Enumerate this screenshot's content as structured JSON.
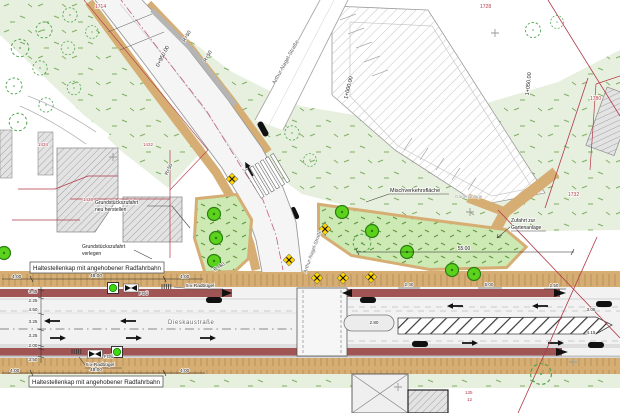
{
  "plan_labels": {
    "stop_cap_top": "Haltestellenkap mit angehobener Radfahrbahn",
    "stop_cap_bottom": "Haltestellenkap mit angehobener Radfahrbahn",
    "mixed_traffic_area": "Mischverkehrsfläche",
    "garden_area_faint": "Gartenanlage",
    "garden_access_l1": "Zufahrt zur",
    "garden_access_l2": "Gartenanlage",
    "driveway_new_l1": "Grundstückszufahrt",
    "driveway_new_l2": "neu herstellen",
    "driveway_relocate_l1": "Grundstückszufahrt",
    "driveway_relocate_l2": "verlegen",
    "bike_racks_top": "5 x Radbügel",
    "bike_racks_bottom": "5 x Radbügel",
    "crosswalk_top": "FGÜ",
    "crosswalk_bottom": "FGÜ"
  },
  "streets": {
    "main": "Dieskaustraße",
    "side_north": "Arthur-Nagel-Straße",
    "side_south": "Arthur-Nagel-Straße"
  },
  "stations": {
    "s0950": "0+950.00",
    "s1000": "1+000.00",
    "s1050": "1+050.00"
  },
  "radii": {
    "r50_a": "R=50",
    "r50_b": "R=50",
    "r50_c": "R=50",
    "r60": "R=60"
  },
  "dimensions": {
    "top_chain": [
      "4.00",
      "48.00",
      "4.00"
    ],
    "bottom_chain": [
      "4.00",
      "48.00",
      "4.00"
    ],
    "cross_section_left": [
      "3.45",
      "2.25",
      "4.50",
      "3.25",
      "3.25",
      "2.00",
      "3.50"
    ],
    "misc": {
      "d55": "55.00",
      "d5": "5.00",
      "d250": "2.50",
      "d240": "2.40",
      "d280": "2.80",
      "d415": "4.15",
      "d305": "3.05"
    }
  },
  "parcels": {
    "p1714": "1714",
    "p1728": "1728",
    "p1780": "1780",
    "p1732": "1732",
    "p1434": "1434",
    "p1432": "1432",
    "p1438": "1438",
    "p135": "135",
    "p12": "12"
  },
  "icons": {
    "tree_icon": "filled green circle (new tree)",
    "existing_tree_icon": "dashed green circle (existing tree)",
    "hazard_x_icon": "yellow diamond with black X",
    "signal_icon": "green circle in black square",
    "crosswalk_sign_icon": "black bowtie symbol",
    "bike_rack_icon": "row of rack bars",
    "bus_icon": "black vehicle pill",
    "lane_arrow_icon": "black lane direction arrow",
    "survey_cross_icon": "gray plus mark"
  },
  "colors": {
    "vegetation": "#e7f0de",
    "island_green": "#cde9b4",
    "tree_green": "#5bd21c",
    "path_tan": "#d6ae74",
    "cycle_track_red": "#a05454",
    "parcel_red": "#b23a48",
    "road_gray": "#f2f2f2",
    "marker_yellow": "#ffd400",
    "signal_green": "#3ddb10"
  }
}
